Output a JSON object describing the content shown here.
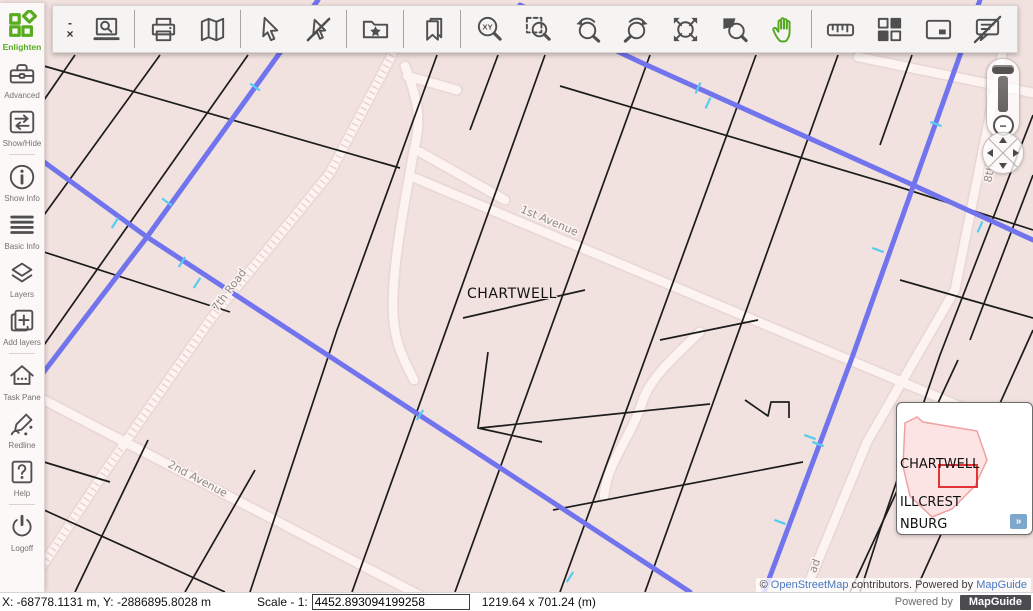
{
  "brand": {
    "name": "Enlighten"
  },
  "window": {
    "minimize": "-",
    "close": "×"
  },
  "sidebar": {
    "items": [
      {
        "label": "Advanced",
        "icon": "toolbox-icon"
      },
      {
        "label": "Show/Hide",
        "icon": "show-hide-arrows-icon"
      },
      {
        "label": "Show Info",
        "icon": "info-circle-icon"
      },
      {
        "label": "Basic Info",
        "icon": "list-lines-icon"
      },
      {
        "label": "Layers",
        "icon": "layers-icon"
      },
      {
        "label": "Add layers",
        "icon": "add-layers-icon"
      },
      {
        "label": "Task Pane",
        "icon": "house-icon"
      },
      {
        "label": "Redline",
        "icon": "pencil-scribble-icon"
      },
      {
        "label": "Help",
        "icon": "question-mark-icon"
      },
      {
        "label": "Logoff",
        "icon": "power-icon"
      }
    ]
  },
  "toolbar": {
    "buttons": [
      {
        "icon": "quick-plot-icon"
      },
      {
        "icon": "print-icon"
      },
      {
        "icon": "folded-map-icon"
      },
      {
        "icon": "select-arrow-icon"
      },
      {
        "icon": "clear-selection-icon"
      },
      {
        "icon": "save-map-folder-star-icon"
      },
      {
        "icon": "bookmarks-icon"
      },
      {
        "icon": "zoom-xy-icon"
      },
      {
        "icon": "zoom-rectangle-icon"
      },
      {
        "icon": "previous-view-icon"
      },
      {
        "icon": "next-view-icon"
      },
      {
        "icon": "zoom-extents-icon"
      },
      {
        "icon": "zoom-to-selection-icon"
      },
      {
        "icon": "pan-hand-icon",
        "active": true
      },
      {
        "icon": "measure-ruler-icon"
      },
      {
        "icon": "view-size-grid-icon"
      },
      {
        "icon": "overview-map-icon"
      },
      {
        "icon": "maptip-off-icon"
      }
    ]
  },
  "map": {
    "labels": {
      "avenue1": "1st Avenue",
      "chartwell": "CHARTWELL",
      "road7": "7th Road",
      "avenue2": "2nd Avenue",
      "road8": "8th",
      "road_fragment": "ad"
    }
  },
  "zoom_control": {
    "minus": "−"
  },
  "overview": {
    "labels": [
      "CHARTWELL",
      "ILLCREST",
      "NBURG"
    ],
    "expand": "»"
  },
  "attribution": {
    "copyright": "© ",
    "osm_link": "OpenStreetMap",
    "middle": " contributors. Powered by ",
    "mapguide_link": "MapGuide"
  },
  "statusbar": {
    "coordinates": "X: -68778.1131 m, Y: -2886895.8028 m",
    "scale_label": "Scale - 1:",
    "scale_value": "4452.893094199258",
    "view_size": "1219.64 x 701.24 (m)",
    "powered_by": "Powered by",
    "mapguide_badge": "MapGuide"
  },
  "colors": {
    "accent_green": "#56ab1e",
    "utility_line_blue": "#7274ee",
    "tick_cyan": "#55ccf0",
    "extent_red": "#e23434",
    "link_blue": "#4978bf"
  }
}
